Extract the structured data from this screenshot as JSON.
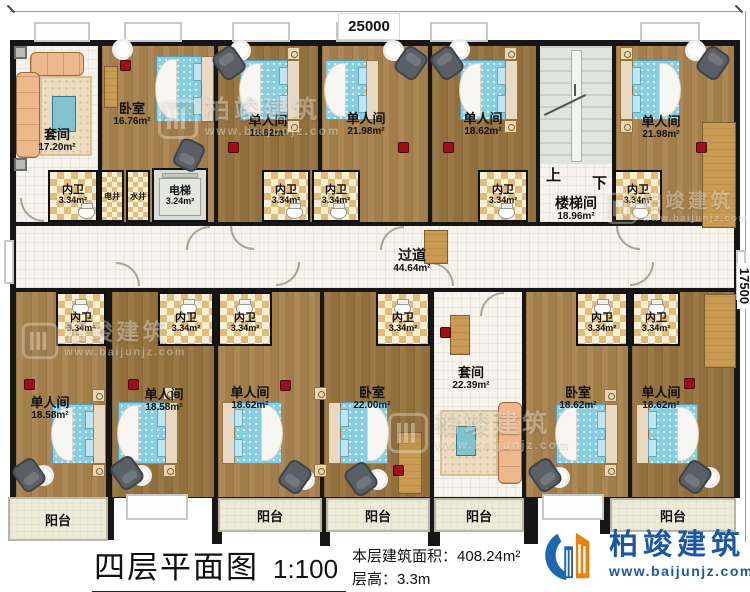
{
  "dims": {
    "top": "25000",
    "right": "17500"
  },
  "rooms": {
    "suite_top": {
      "name": "套间",
      "area": "17.20m²"
    },
    "bedroom_top": {
      "name": "卧室",
      "area": "16.76m²"
    },
    "single_t1": {
      "name": "单人间",
      "area": "18.62m²"
    },
    "single_t2": {
      "name": "单人间",
      "area": "21.98m²"
    },
    "single_t3": {
      "name": "单人间",
      "area": "18.62m²"
    },
    "single_t4": {
      "name": "单人间",
      "area": "21.98m²"
    },
    "stairwell": {
      "name": "楼梯间",
      "area": "18.96m²",
      "up": "上",
      "down": "下"
    },
    "elevator": {
      "name": "电梯",
      "area": "3.24m²"
    },
    "shaft_electric": {
      "name": "电井"
    },
    "shaft_water": {
      "name": "水井"
    },
    "corridor": {
      "name": "过道",
      "area": "44.64m²"
    },
    "single_b1": {
      "name": "单人间",
      "area": "18.58m²"
    },
    "single_b2": {
      "name": "单人间",
      "area": "18.58m²"
    },
    "single_b3": {
      "name": "单人间",
      "area": "18.62m²"
    },
    "bedroom_b1": {
      "name": "卧室",
      "area": "22.00m²"
    },
    "suite_bottom": {
      "name": "套间",
      "area": "22.39m²"
    },
    "bedroom_b2": {
      "name": "卧室",
      "area": "18.62m²"
    },
    "single_b4": {
      "name": "单人间",
      "area": "18.62m²"
    }
  },
  "bath": {
    "name": "内卫",
    "area": "3.34m²"
  },
  "balcony": {
    "name": "阳台"
  },
  "title_block": {
    "title": "四层平面图",
    "scale": "1:100",
    "area_label": "本层建筑面积：",
    "area_value": "408.24m²",
    "height_label": "层高：",
    "height_value": "3.3m"
  },
  "brand": {
    "name": "柏竣建筑",
    "website": "www.baijunjz.com"
  }
}
